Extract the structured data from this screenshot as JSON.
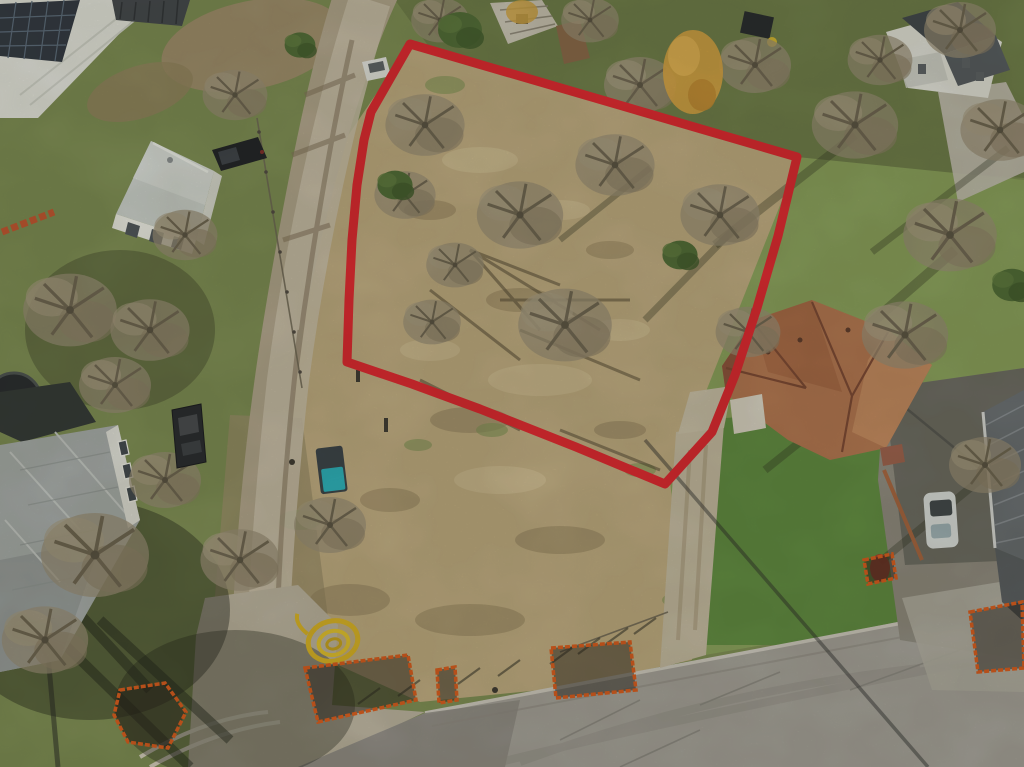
{
  "meta": {
    "description": "Aerial drone photograph of a vacant residential corner lot outlined with a red property boundary, surrounded by houses, a dirt road, trees and construction fencing",
    "width": 1024,
    "height": 767
  },
  "scene": {
    "type": "aerial-drone-photo",
    "subject": "vacant lot for sale with red boundary overlay",
    "season": "winter-bare-trees"
  },
  "boundary": {
    "color": "#e2232b",
    "stroke_width": 9,
    "points": [
      [
        410,
        44
      ],
      [
        797,
        157
      ],
      [
        778,
        236
      ],
      [
        757,
        308
      ],
      [
        735,
        375
      ],
      [
        712,
        432
      ],
      [
        665,
        484
      ],
      [
        576,
        447
      ],
      [
        480,
        409
      ],
      [
        412,
        384
      ],
      [
        347,
        362
      ],
      [
        349,
        300
      ],
      [
        352,
        240
      ],
      [
        357,
        185
      ],
      [
        364,
        140
      ],
      [
        371,
        112
      ]
    ]
  },
  "site_features": {
    "excavation_pit_fence_color": "#dd5a17",
    "excavation_pits": [
      [
        [
          120,
          690
        ],
        [
          165,
          683
        ],
        [
          186,
          712
        ],
        [
          168,
          748
        ],
        [
          128,
          742
        ],
        [
          114,
          715
        ]
      ],
      [
        [
          305,
          668
        ],
        [
          408,
          655
        ],
        [
          416,
          700
        ],
        [
          318,
          722
        ]
      ],
      [
        [
          437,
          670
        ],
        [
          455,
          667
        ],
        [
          457,
          700
        ],
        [
          439,
          703
        ]
      ],
      [
        [
          551,
          648
        ],
        [
          630,
          642
        ],
        [
          636,
          690
        ],
        [
          556,
          698
        ]
      ],
      [
        [
          970,
          612
        ],
        [
          1022,
          602
        ],
        [
          1024,
          668
        ],
        [
          978,
          672
        ]
      ],
      [
        [
          864,
          560
        ],
        [
          892,
          554
        ],
        [
          896,
          578
        ],
        [
          868,
          584
        ]
      ]
    ],
    "hose_coil_color": "#ddb61f",
    "portable_toilet_body_color": "#374046",
    "portable_toilet_lid_color": "#27b2c0"
  },
  "palette": {
    "dry_lot": "#c2ae83",
    "green_lawn": "#8aa35b",
    "vivid_lawn": "#5f8d3e",
    "dirt_road": "#b3a78f",
    "road_center": "#ccc3b0",
    "street_pavement": "#a7a49e",
    "concrete_apron": "#bdb5a3",
    "brown_roof": "#b5764f",
    "gray_roof": "#a9afb0",
    "bare_tree": "#9a8f77",
    "evergreen": "#4e6b33",
    "golden_tree": "#d9a440"
  },
  "objects": [
    {
      "name": "property-boundary",
      "desc": "red outlined quadrilateral lot"
    },
    {
      "name": "dirt-road",
      "desc": "unpaved road running along left side of lot"
    },
    {
      "name": "paved-street",
      "desc": "asphalt street across bottom right"
    },
    {
      "name": "industrial-building",
      "desc": "white roof building with solar panels, top left"
    },
    {
      "name": "small-gray-house",
      "desc": "small house with light gray roof and black pickup, upper left"
    },
    {
      "name": "large-gray-house",
      "desc": "large gray shingle roof house, bottom left"
    },
    {
      "name": "brown-roof-house",
      "desc": "terracotta hip-roof house right of lot"
    },
    {
      "name": "corrugated-roof-house",
      "desc": "dark corrugated roof house, far right"
    },
    {
      "name": "white-two-story-house",
      "desc": "white house behind trees, top right"
    },
    {
      "name": "white-car-road",
      "desc": "white car on dirt road at top"
    },
    {
      "name": "black-pickup",
      "desc": "dark pickup truck beside small house"
    },
    {
      "name": "dark-sedan",
      "desc": "dark sedan parked bottom left"
    },
    {
      "name": "white-car-driveway",
      "desc": "white car on shaded driveway, right"
    },
    {
      "name": "portable-toilet",
      "desc": "porta-potty with teal lid mid-frame"
    },
    {
      "name": "yellow-hose-coil",
      "desc": "coiled yellow pipe near bottom"
    },
    {
      "name": "excavation-pits",
      "desc": "orange construction fence enclosures along street"
    }
  ]
}
